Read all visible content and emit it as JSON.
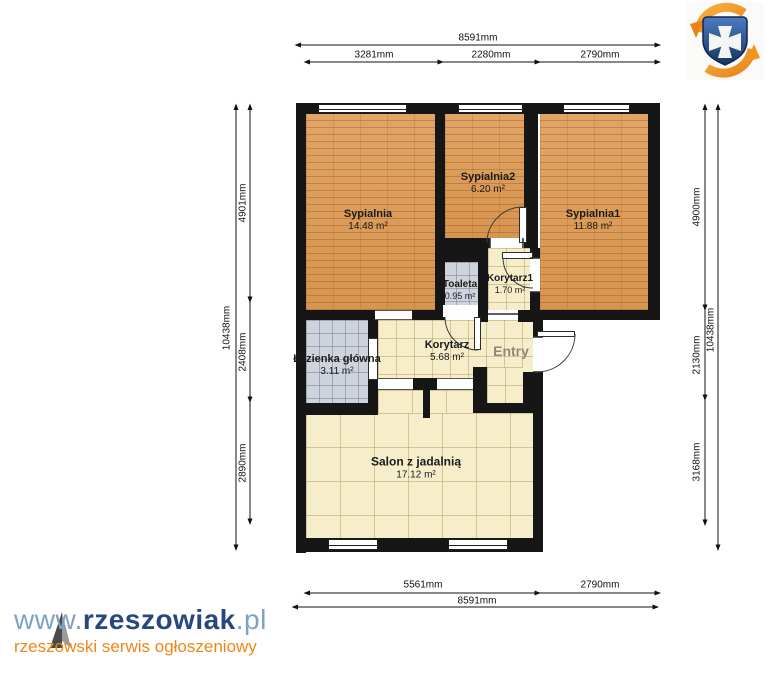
{
  "title": "Apartment floor plan",
  "rooms": {
    "sypialnia": {
      "name": "Sypialnia",
      "area": "14.48 m²"
    },
    "sypialnia2": {
      "name": "Sypialnia2",
      "area": "6.20 m²"
    },
    "sypialnia1": {
      "name": "Sypialnia1",
      "area": "11.88 m²"
    },
    "toaleta": {
      "name": "Toaleta",
      "area": "0.95 m²"
    },
    "korytarz1": {
      "name": "Korytarz1",
      "area": "1.70 m²"
    },
    "lazienka": {
      "name": "Łazienka główna",
      "area": "3.11 m²"
    },
    "korytarz": {
      "name": "Korytarz",
      "area": "5.68 m²"
    },
    "entry": {
      "name": "Entry"
    },
    "salon": {
      "name": "Salon z jadalnią",
      "area": "17.12 m²"
    }
  },
  "dims": {
    "top_total": "8591mm",
    "top_segments": [
      "3281mm",
      "2280mm",
      "2790mm"
    ],
    "bottom_segments": [
      "5561mm",
      "2790mm"
    ],
    "bottom_total": "8591mm",
    "left_total": "10438mm",
    "left_segments": [
      "4901mm",
      "2408mm",
      "2890mm"
    ],
    "right_total": "10438mm",
    "right_segments": [
      "4900mm",
      "2130mm",
      "3168mm"
    ]
  },
  "watermark": {
    "www": "www.",
    "brand": "rzeszowiak",
    "tld": ".pl",
    "tagline": "rzeszowski serwis ogłoszeniowy"
  },
  "icons": {
    "logo": "rzeszowiak-shield-logo",
    "north": "north-arrow"
  },
  "colors": {
    "wall": "#161616",
    "wood_floor": "#dd9f62",
    "tile_floor": "#f6eecb",
    "bath_floor": "#cfd4dc",
    "brand_navy": "#27477e",
    "brand_blue": "#7ca2c4",
    "brand_orange": "#f08616"
  }
}
